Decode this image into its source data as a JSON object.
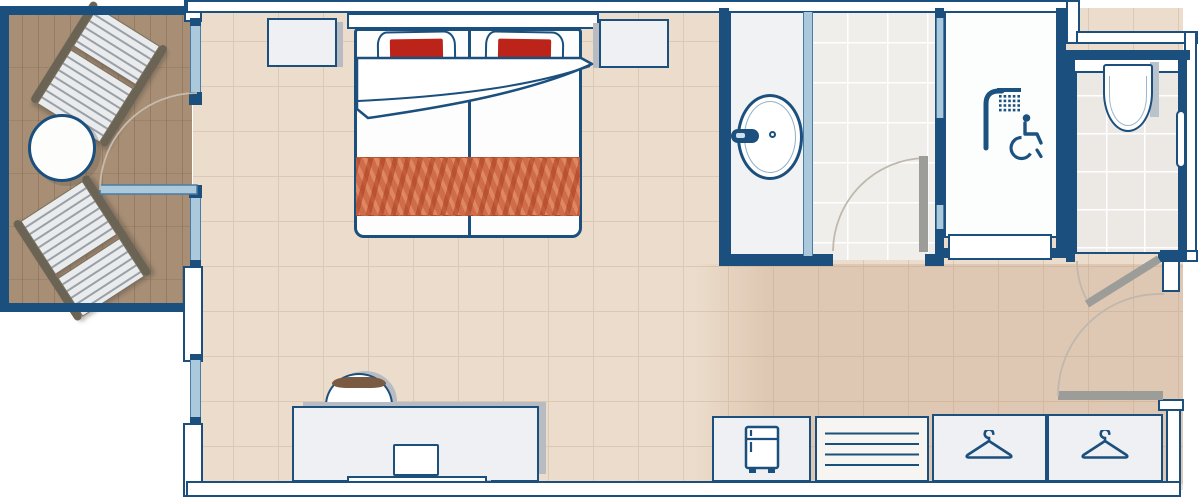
{
  "title": "accessible-hotel-room-floor-plan",
  "colors": {
    "wall_navy": "#1b4f7d",
    "glass_blue": "#aac9dd",
    "bedroom_floor": "#ebdccb",
    "entry_floor_tint": "#c9a37e",
    "balcony_wood": "#a78e75",
    "bathroom_floor": "#efeeeb",
    "pillow_red": "#bd2419",
    "runner_terracotta": "#cf6c4a",
    "door_leaf_gray": "#9c9c98",
    "shadow_gray": "#b8bcc2",
    "chair_wood_brown": "#7b5a42"
  },
  "rooms": [
    {
      "id": "balcony",
      "name": "Balcony with loungers and table"
    },
    {
      "id": "bedroom",
      "name": "Bedroom"
    },
    {
      "id": "vanity",
      "name": "Washbasin area"
    },
    {
      "id": "bathroom",
      "name": "Bathroom"
    },
    {
      "id": "shower",
      "name": "Roll-in accessible shower"
    },
    {
      "id": "wc",
      "name": "WC"
    },
    {
      "id": "entry",
      "name": "Entry hall"
    }
  ],
  "furniture": [
    {
      "id": "double-bed",
      "desc": "double bed with two red pillows and terracotta runner"
    },
    {
      "id": "headboard",
      "desc": "headboard"
    },
    {
      "id": "nightstand-left",
      "desc": "nightstand"
    },
    {
      "id": "nightstand-right",
      "desc": "nightstand"
    },
    {
      "id": "desk",
      "desc": "desk with chair, monitor and console shelf"
    },
    {
      "id": "minibar",
      "desc": "minibar cabinet"
    },
    {
      "id": "slatted-unit",
      "desc": "slatted luggage/shelf unit"
    },
    {
      "id": "wardrobe-left",
      "desc": "wardrobe section with hanger"
    },
    {
      "id": "wardrobe-right",
      "desc": "wardrobe section with hanger"
    },
    {
      "id": "lounger-1",
      "desc": "balcony lounger"
    },
    {
      "id": "lounger-2",
      "desc": "balcony lounger"
    },
    {
      "id": "round-table",
      "desc": "round balcony table"
    }
  ],
  "fixtures": [
    {
      "id": "washbasin",
      "desc": "oval washbasin with faucet"
    },
    {
      "id": "toilet",
      "desc": "wall-hung toilet with grab bar"
    },
    {
      "id": "shower-head",
      "desc": "shower"
    },
    {
      "id": "accessibility",
      "desc": "wheelchair accessible symbol"
    }
  ],
  "doors": [
    {
      "id": "balcony-door",
      "type": "glass swing door"
    },
    {
      "id": "bathroom-door",
      "type": "swing door"
    },
    {
      "id": "wc-door",
      "type": "swing door, ajar"
    },
    {
      "id": "entrance-door",
      "type": "swing door"
    }
  ],
  "icons": [
    "shower-icon",
    "wheelchair-accessibility-icon",
    "hanger-icon",
    "fridge-icon"
  ]
}
